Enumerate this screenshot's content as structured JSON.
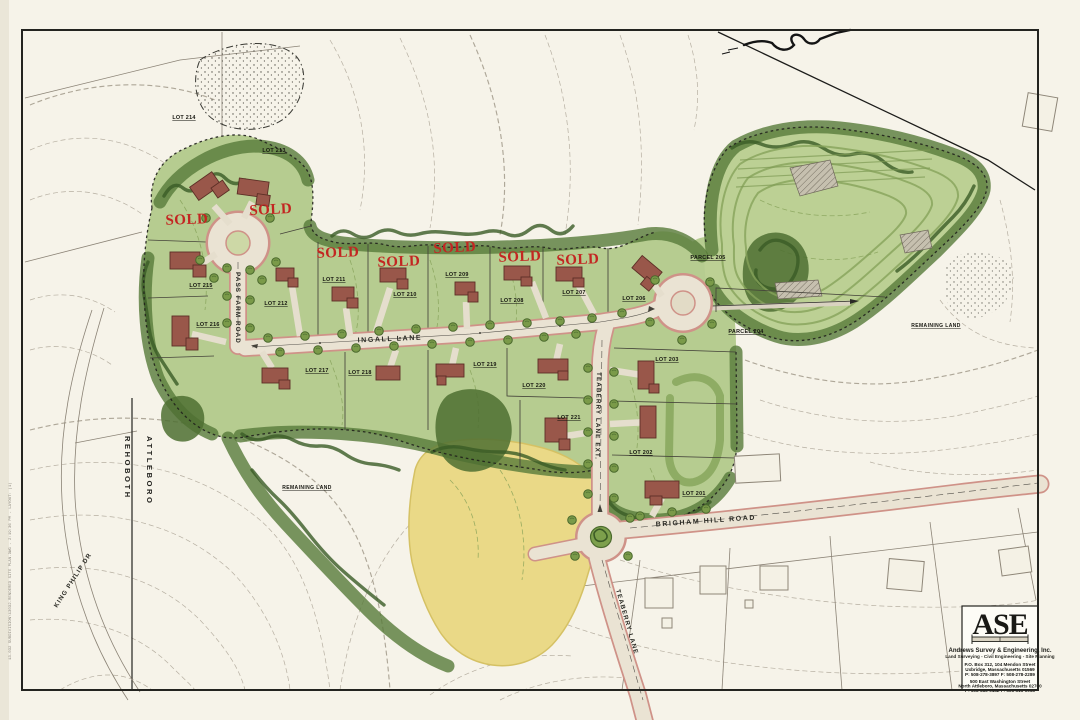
{
  "sheet": {
    "towns": {
      "west": "REHOBOTH",
      "east": "ATTLEBORO"
    }
  },
  "labels": {
    "sold": "SOLD",
    "remaining_land": "REMAINING LAND",
    "lots": {
      "l201": "LOT 201",
      "l202": "LOT 202",
      "l203": "LOT 203",
      "l206": "LOT 206",
      "l207": "LOT 207",
      "l208": "LOT 208",
      "l209": "LOT 209",
      "l210": "LOT 210",
      "l211": "LOT 211",
      "l212": "LOT 212",
      "l213": "LOT 213",
      "l214": "LOT 214",
      "l215": "LOT 215",
      "l216": "LOT 216",
      "l217": "LOT 217",
      "l218": "LOT 218",
      "l219": "LOT 219",
      "l220": "LOT 220",
      "l221": "LOT 221"
    },
    "parcels": {
      "p204": "PARCEL 204",
      "p205": "PARCEL 205"
    }
  },
  "roads": {
    "pass_farm": "PASS FARM ROAD",
    "ingall": "INGALL LANE",
    "teaberry_ext": "TEABERRY LANE EXT.",
    "teaberry": "TEABERRY LANE",
    "brigham": "BRIGHAM HILL ROAD",
    "king_philip": "KING PHILIP DR"
  },
  "title_block": {
    "logo": "ASE",
    "company": "Andrews Survey & Engineering, Inc.",
    "tagline": "Land Surveying - Civil Engineering - Site Planning",
    "office1": {
      "line1": "P.O. Box 312, 104 Mendon Street",
      "line2": "Uxbridge, Massachusetts 01569",
      "line3": "P: 508-278-3897    F: 508-278-2289"
    },
    "office2": {
      "line1": "500 East Washington Street",
      "line2": "North Attleboro, Massachusetts 02760",
      "line3": "P: 508-316-0452    F: 508-316-0963"
    }
  },
  "plot_stamp": "13-032 SUBDIVISION\\13032-RENDERED SITE PLAN.DWG - 2:19:36 PM - LAYOUT: (1)",
  "colors": {
    "paper": "#f6f3e9",
    "lot_green": "#b6cc90",
    "tree_green": "#3a5b26",
    "field_yellow": "#ead987",
    "road_edge_pink": "#cf9288",
    "sold_red": "#c32622"
  }
}
